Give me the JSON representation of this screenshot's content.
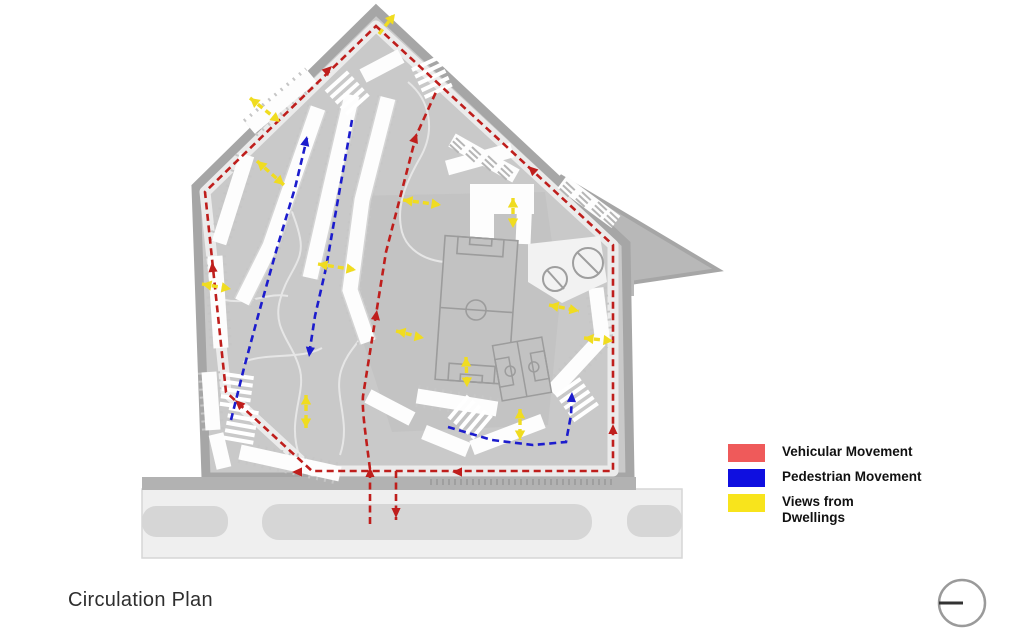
{
  "title": "Circulation Plan",
  "legend": {
    "items": [
      {
        "id": "vehicular",
        "label": "Vehicular Movement",
        "swatch_color": "#ef5a5a",
        "line_color": "#bf1e1c"
      },
      {
        "id": "pedestrian",
        "label": "Pedestrian Movement",
        "swatch_color": "#0f0fe0",
        "line_color": "#1c1ccd"
      },
      {
        "id": "views",
        "label": "Views from Dwellings",
        "swatch_color": "#f8e41c",
        "line_color": "#f0dc20"
      }
    ]
  },
  "plan": {
    "colors": {
      "site_fill": "#c9c9c9",
      "boundary": "#a6a6a6",
      "building": "#fdfdfd",
      "road_fill": "#efefef",
      "road_island": "#d6d6d6"
    }
  },
  "icons": {
    "north_indicator": "circle-with-horizontal-line"
  }
}
